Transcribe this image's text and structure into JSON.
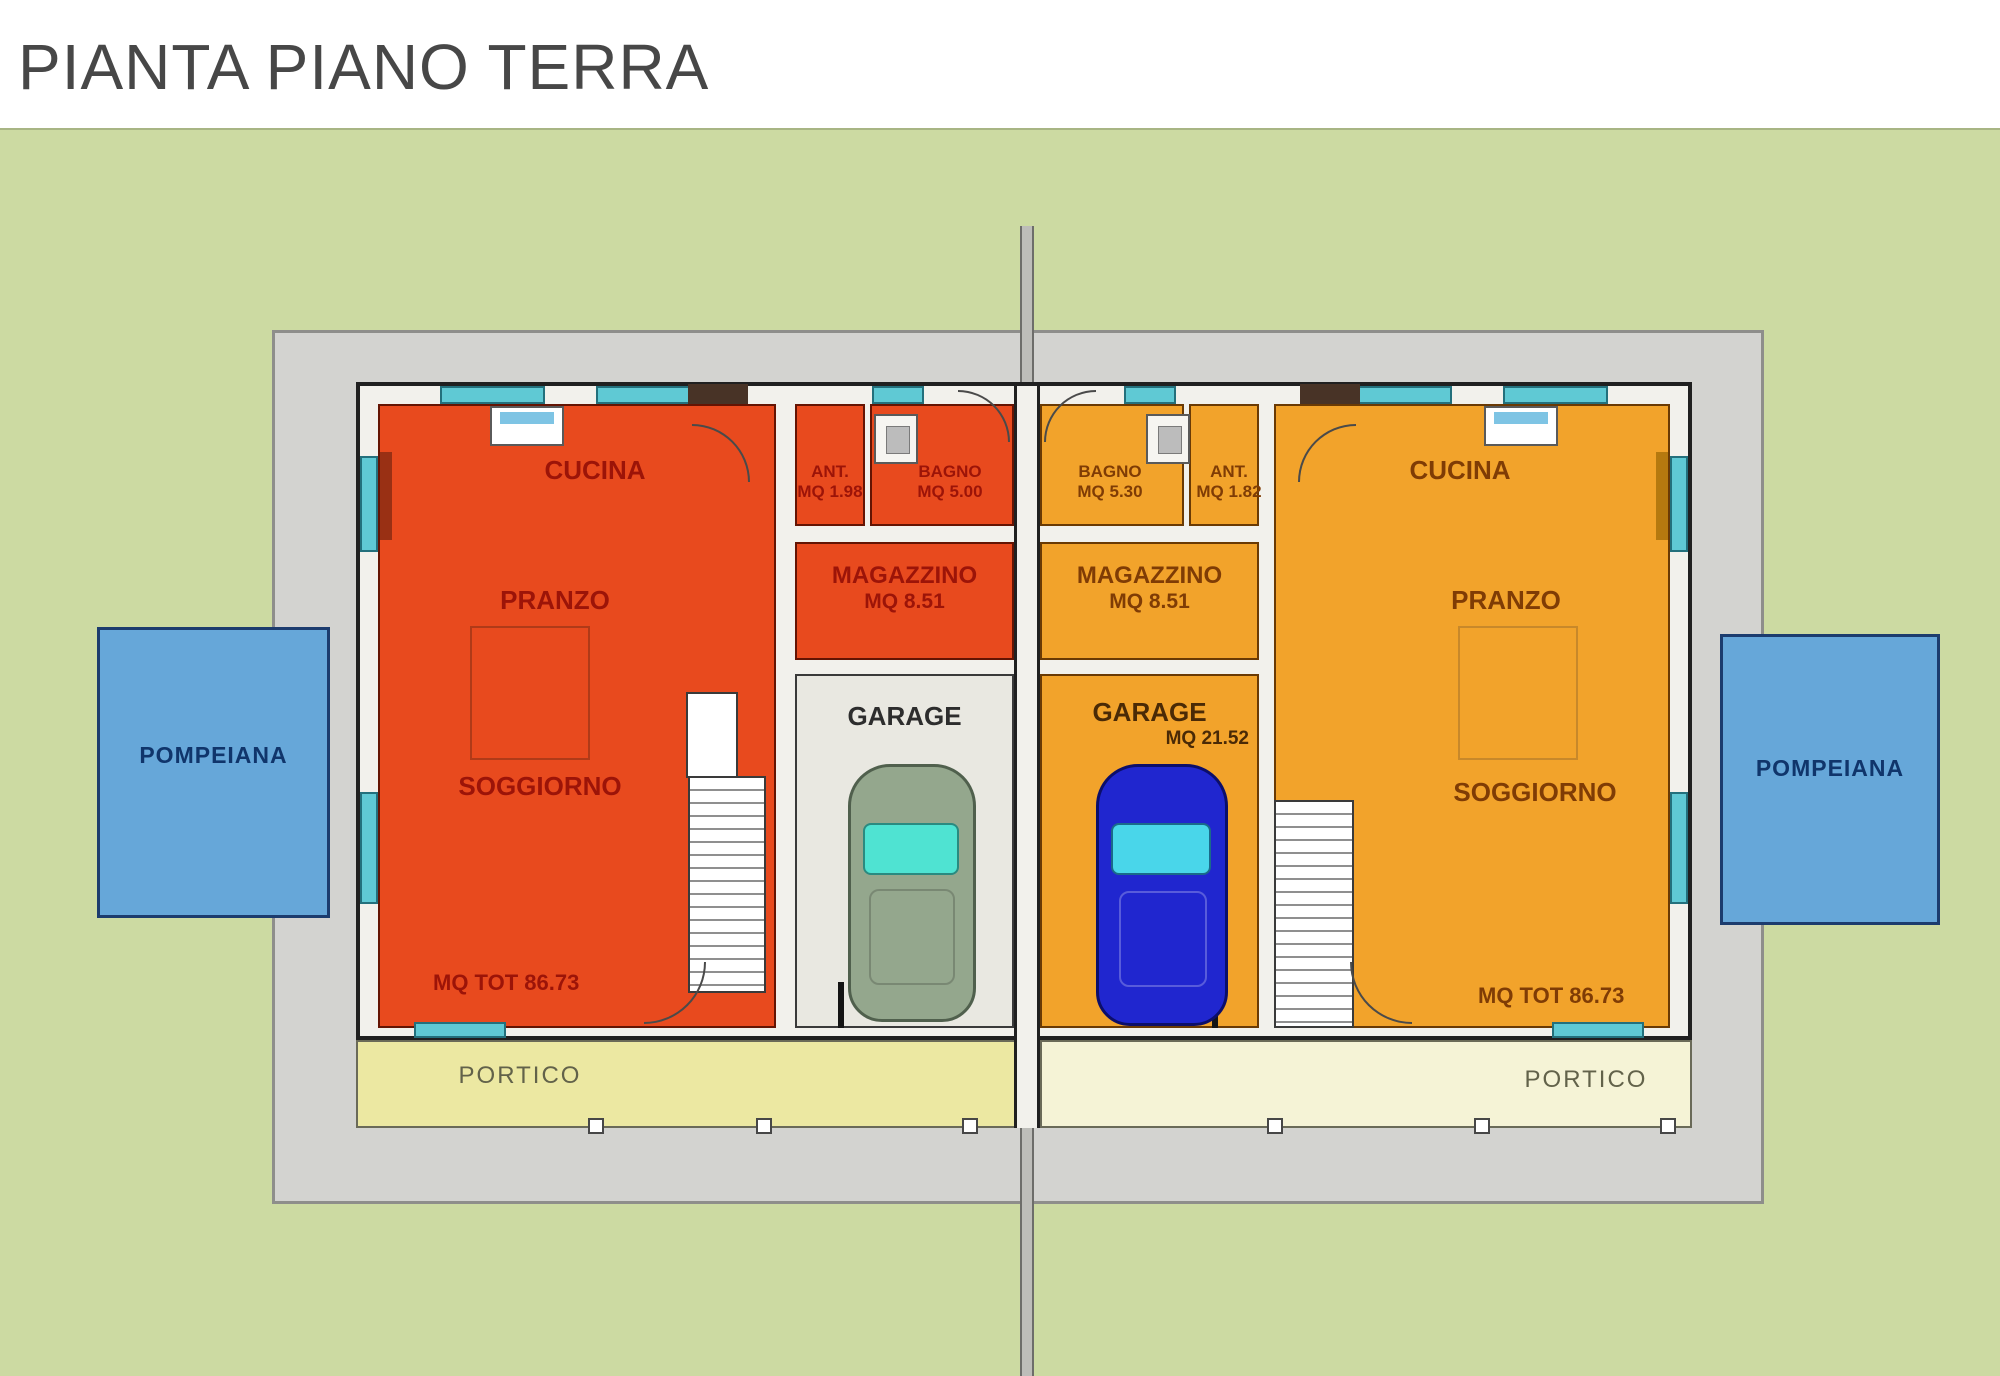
{
  "title": "PIANTA PIANO TERRA",
  "site": {
    "pompeiana_left": "POMPEIANA",
    "pompeiana_right": "POMPEIANA",
    "portico_left": "PORTICO",
    "portico_right": "PORTICO"
  },
  "left_unit": {
    "cucina": "CUCINA",
    "pranzo": "PRANZO",
    "soggiorno": "SOGGIORNO",
    "ant_label": "ANT.",
    "ant_area": "MQ 1.98",
    "bagno_label": "BAGNO",
    "bagno_area": "MQ 5.00",
    "magazzino_label": "MAGAZZINO",
    "magazzino_area": "MQ 8.51",
    "garage_label": "GARAGE",
    "total_area": "MQ TOT 86.73"
  },
  "right_unit": {
    "cucina": "CUCINA",
    "pranzo": "PRANZO",
    "soggiorno": "SOGGIORNO",
    "ant_label": "ANT.",
    "ant_area": "MQ 1.82",
    "bagno_label": "BAGNO",
    "bagno_area": "MQ 5.30",
    "magazzino_label": "MAGAZZINO",
    "magazzino_area": "MQ 8.51",
    "garage_label": "GARAGE",
    "garage_area": "MQ 21.52",
    "total_area": "MQ TOT 86.73"
  },
  "colors": {
    "left_unit_fill": "#e84a1e",
    "right_unit_fill": "#f2a32b",
    "lawn": "#ccdaa2",
    "lot": "#d3d3d0",
    "window": "#5fc9d4",
    "pompeiana_fill": "#66a7d9",
    "portico_left_fill": "#ece8a2",
    "portico_right_fill": "#f5f3d6",
    "car_left": "#94a78d",
    "car_right": "#2026cf"
  }
}
